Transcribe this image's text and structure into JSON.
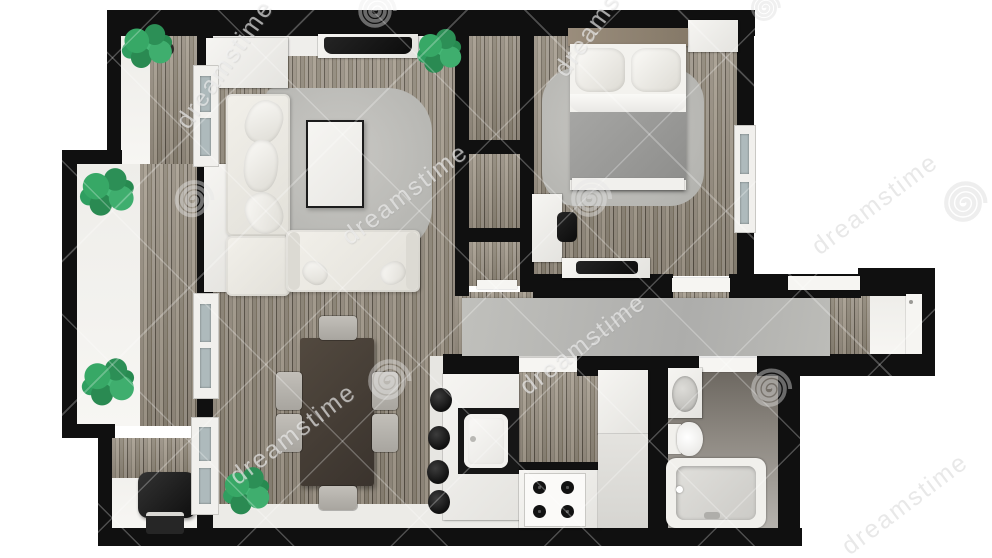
{
  "title": "Apartment floor plan, 3D render, top view",
  "watermark": {
    "text": "dreamstime",
    "logo": "dreamstime-spiral-logo"
  },
  "colors": {
    "background": "#ffffff",
    "wall": "#101010",
    "wood_floor_light": "#a59c8e",
    "wood_floor_dark": "#6e6659",
    "area_rug": "#c2c1bd",
    "runner_rug": "#b7b8b4",
    "upholstery_white": "#eceae5",
    "bed_blanket_gray": "#9c9c9a",
    "dining_table_wood": "#453e38",
    "chair_gray": "#b6b3ad",
    "plant_green": "#2f9e60",
    "bathroom_floor": "#8b8680",
    "appliance_black": "#161616",
    "watermark_white": "rgba(255,255,255,0.6)"
  },
  "rooms": [
    {
      "id": "balcony",
      "label": "Balcony",
      "items": [
        "potted plant",
        "potted plant",
        "potted plant",
        "planter bench",
        "bbq grill",
        "casement windows"
      ]
    },
    {
      "id": "living-room",
      "label": "Living room",
      "items": [
        "corner sofa",
        "two-seat sofa",
        "coffee table",
        "wall tv",
        "area rug",
        "sideboard",
        "potted plant",
        "closet"
      ]
    },
    {
      "id": "dining-room",
      "label": "Dining room",
      "items": [
        "dark wood dining table",
        "six gray chairs",
        "potted plant"
      ]
    },
    {
      "id": "hall-closets",
      "label": "Hall closets",
      "items": [
        "wardrobe",
        "wardrobe",
        "entry closet"
      ]
    },
    {
      "id": "bedroom",
      "label": "Bedroom",
      "items": [
        "double bed",
        "area rug",
        "desk",
        "desk chair",
        "tv stand",
        "wardrobe",
        "window"
      ]
    },
    {
      "id": "corridor",
      "label": "Corridor",
      "items": [
        "gray runner rug",
        "entry door"
      ]
    },
    {
      "id": "kitchen",
      "label": "Kitchen",
      "items": [
        "island with sink",
        "four bar stools",
        "gas stove",
        "fridge cabinets"
      ]
    },
    {
      "id": "bathroom",
      "label": "Bathroom",
      "items": [
        "washbasin",
        "toilet",
        "bathtub"
      ]
    }
  ]
}
